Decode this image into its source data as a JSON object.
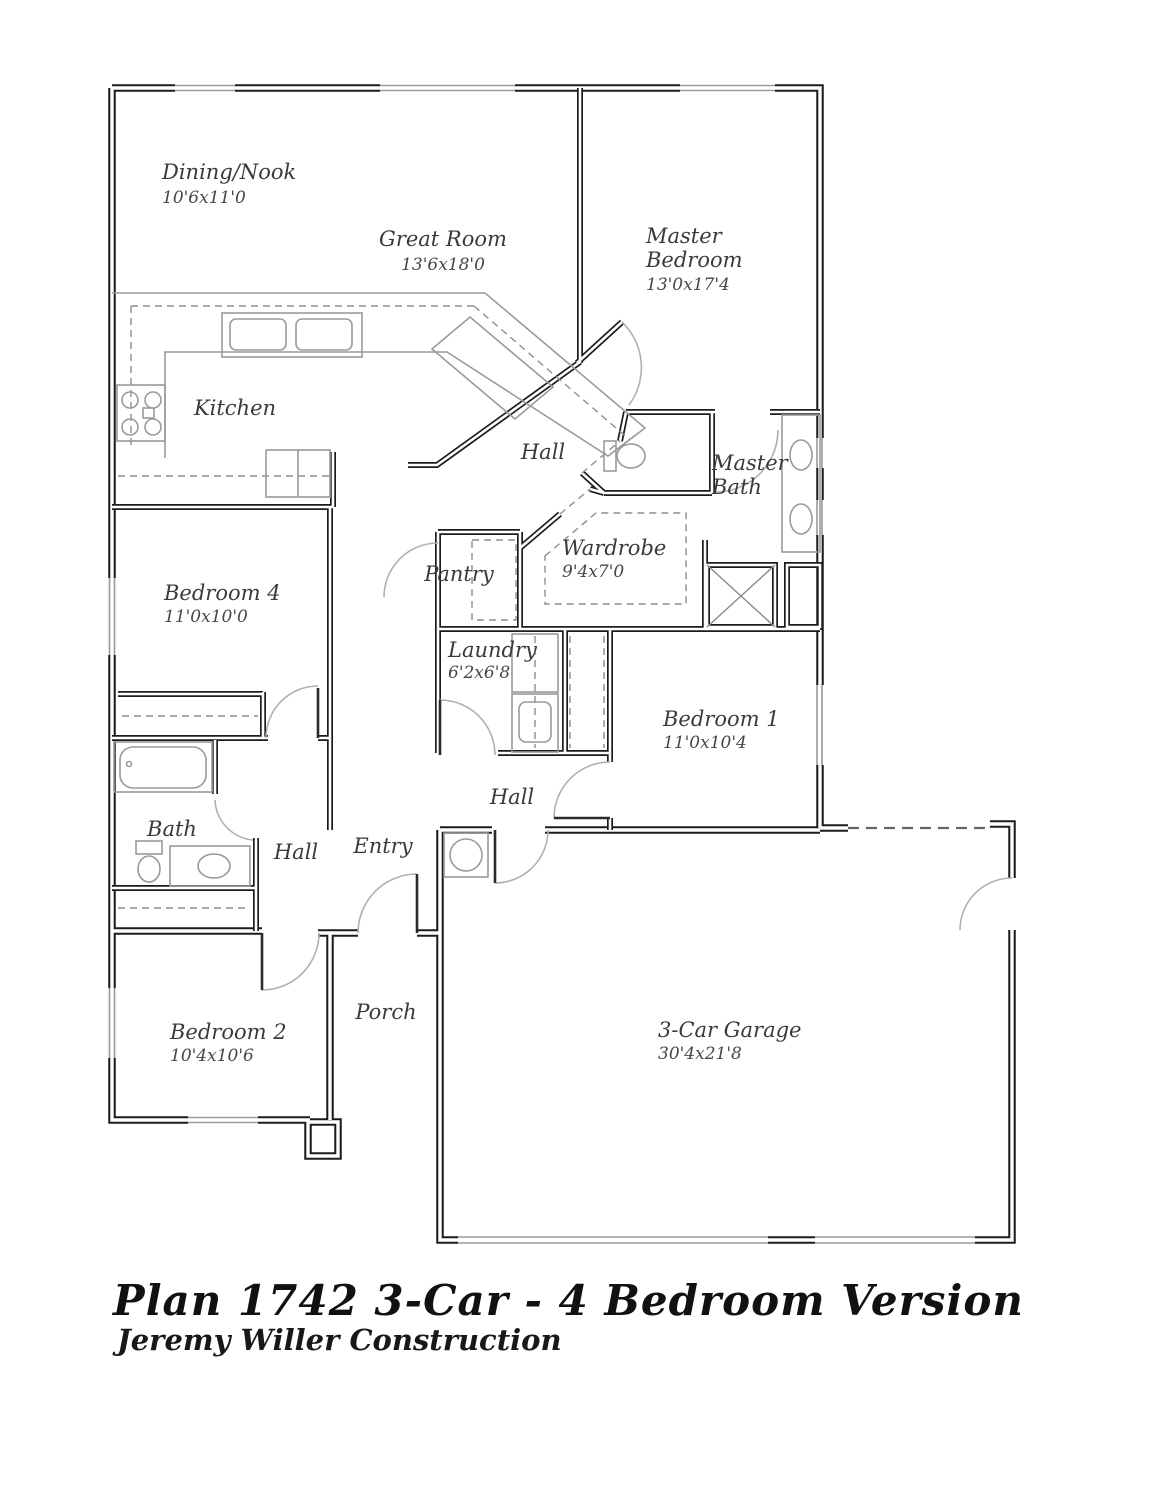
{
  "title_block": {
    "title": "Plan 1742 3-Car - 4 Bedroom Version",
    "subtitle": "Jeremy Willer Construction"
  },
  "rooms": {
    "dining": {
      "name": "Dining/Nook",
      "dims": "10'6x11'0"
    },
    "great": {
      "name": "Great Room",
      "dims": "13'6x18'0"
    },
    "master": {
      "line1": "Master",
      "line2": "Bedroom",
      "dims": "13'0x17'4"
    },
    "kitchen": {
      "name": "Kitchen"
    },
    "hall_upper": {
      "name": "Hall"
    },
    "master_bath": {
      "line1": "Master",
      "line2": "Bath"
    },
    "pantry": {
      "name": "Pantry"
    },
    "wardrobe": {
      "name": "Wardrobe",
      "dims": "9'4x7'0"
    },
    "bedroom4": {
      "name": "Bedroom 4",
      "dims": "11'0x10'0"
    },
    "laundry": {
      "name": "Laundry",
      "dims": "6'2x6'8"
    },
    "bedroom1": {
      "name": "Bedroom 1",
      "dims": "11'0x10'4"
    },
    "bath": {
      "name": "Bath"
    },
    "hall_left": {
      "name": "Hall"
    },
    "entry": {
      "name": "Entry"
    },
    "hall_center": {
      "name": "Hall"
    },
    "bedroom2": {
      "name": "Bedroom 2",
      "dims": "10'4x10'6"
    },
    "porch": {
      "name": "Porch"
    },
    "garage": {
      "name": "3-Car Garage",
      "dims": "30'4x21'8"
    }
  },
  "fixtures": [
    "kitchen-double-sink",
    "stove",
    "dishwasher",
    "refrigerator",
    "bathtub",
    "toilet",
    "vanity-sink",
    "master-toilet",
    "master-double-vanity",
    "shower",
    "linen-closet",
    "washer-dryer",
    "water-heater"
  ],
  "colors": {
    "wall": "#1c1c1c",
    "fixture": "#9a9a9a",
    "label": "#3a3a3a",
    "background": "#ffffff"
  }
}
